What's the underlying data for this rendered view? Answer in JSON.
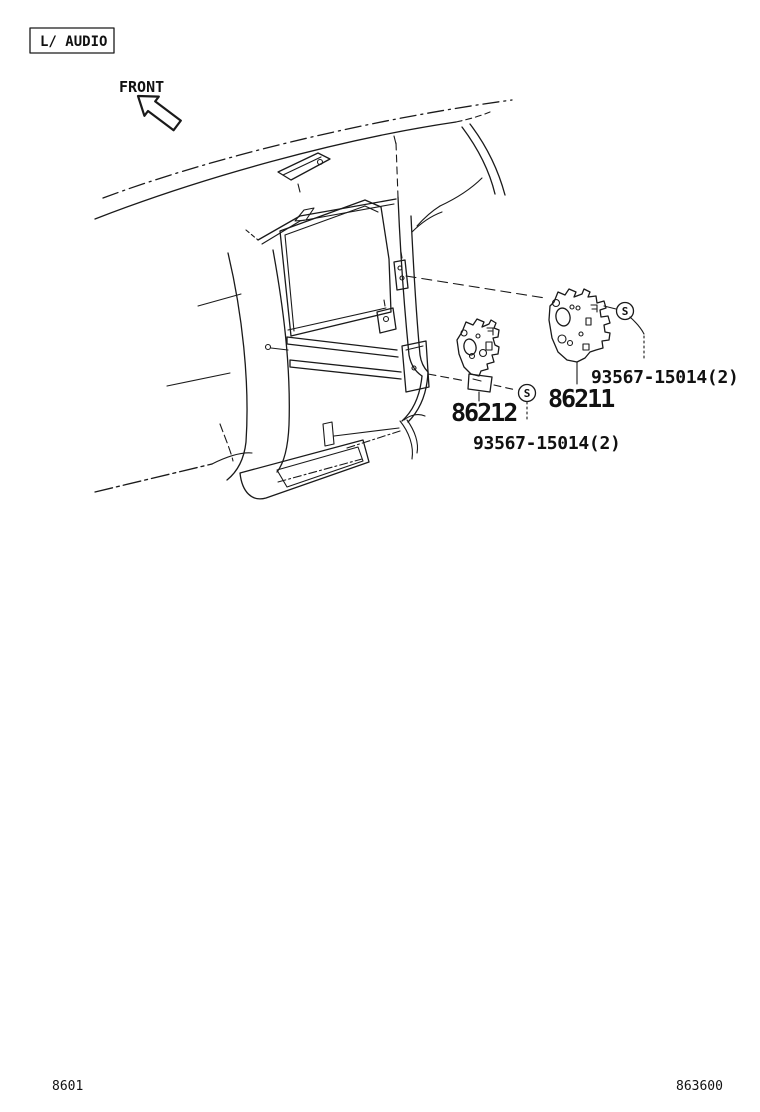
{
  "header": {
    "category_label": "L/ AUDIO"
  },
  "orientation": {
    "front_label": "FRONT"
  },
  "parts": {
    "bracket_right": {
      "number": "86211",
      "screw": "93567-15014(2)",
      "symbol": "S"
    },
    "bracket_left": {
      "number": "86212",
      "screw": "93567-15014(2)",
      "symbol": "S"
    }
  },
  "footer": {
    "page_code": "8601",
    "figure_code": "863600"
  },
  "colors": {
    "line": "#1a1a1a",
    "background": "#ffffff"
  }
}
